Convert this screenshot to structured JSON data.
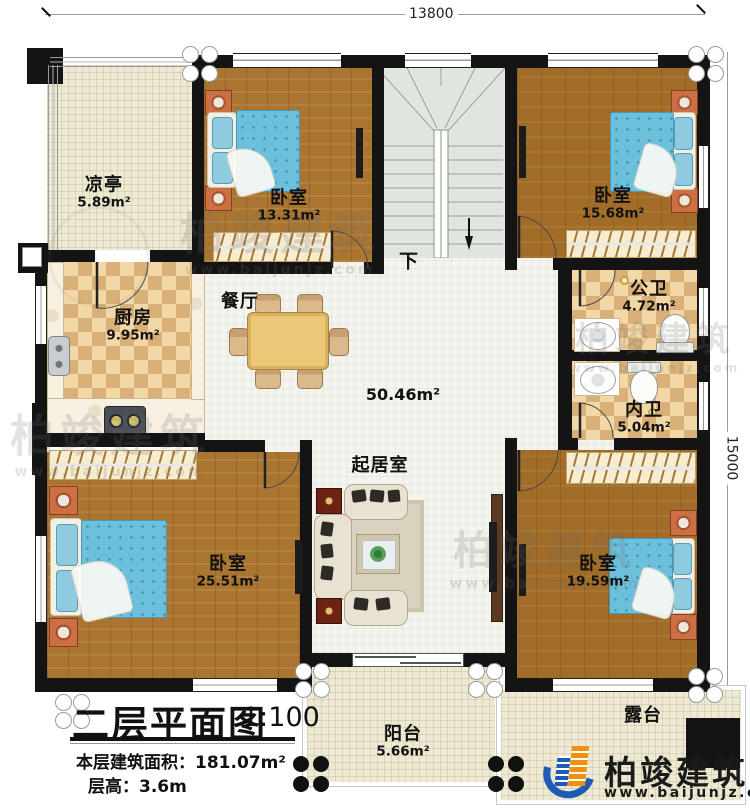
{
  "dimensions": {
    "top": "13800",
    "right": "15000"
  },
  "rooms": {
    "pavilion": {
      "name": "凉亭",
      "area": "5.89m²"
    },
    "bedroom_top_left": {
      "name": "卧室",
      "area": "13.31m²"
    },
    "bedroom_top_right": {
      "name": "卧室",
      "area": "15.68m²"
    },
    "kitchen": {
      "name": "厨房",
      "area": "9.95m²"
    },
    "dining": {
      "name": "餐厅"
    },
    "open_area": {
      "area": "50.46m²"
    },
    "public_bath": {
      "name": "公卫",
      "area": "4.72m²"
    },
    "inner_bath": {
      "name": "内卫",
      "area": "5.04m²"
    },
    "bedroom_bottom_left": {
      "name": "卧室",
      "area": "25.51m²"
    },
    "living": {
      "name": "起居室"
    },
    "bedroom_bottom_right": {
      "name": "卧室",
      "area": "19.59m²"
    },
    "balcony": {
      "name": "阳台",
      "area": "5.66m²"
    },
    "terrace": {
      "name": "露台"
    },
    "stairs": {
      "direction_label": "下"
    }
  },
  "title_block": {
    "plan_title": "二层平面图",
    "scale": "1:100",
    "area_line": "本层建筑面积：181.07m²",
    "height_line": "层高：3.6m"
  },
  "brand": {
    "name": "柏竣建筑",
    "url": "www.baijunjz.com"
  },
  "watermark": {
    "name": "柏竣建筑",
    "url": "www.baijunjz.com"
  },
  "colors": {
    "wall": "#141414",
    "wood": "#aa7530",
    "tile": "#f4f4ee",
    "cream": "#eee9d3",
    "checker_dark": "#d9b077",
    "checker_light": "#f2d8a6",
    "stairs": "#e0e5df",
    "mattress_blue": "#6cc0dc",
    "logo_blue": "#1f5bb5",
    "logo_orange": "#f0900f"
  }
}
